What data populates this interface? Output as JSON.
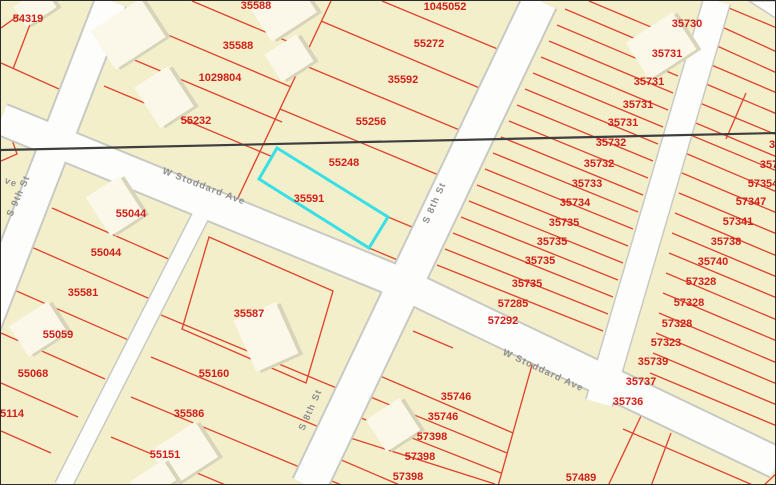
{
  "colors": {
    "parcel_fill": "#f3efcb",
    "parcel_line": "#e0452f",
    "parcel_label": "#d01f18",
    "street_fill": "#fdfdfb",
    "street_casing": "#c9c9c3",
    "street_label": "#8f8f8f",
    "building_fill": "#fbf8e9",
    "building_shadow": "#d8d4ba",
    "highlight": "#38dfe6",
    "boundary": "#3e3e3e",
    "border": "#2b2b2b"
  },
  "streets": {
    "names": [
      "S 9th St",
      "W Stoddard Ave",
      "S 8th St"
    ],
    "fragment": "ve"
  },
  "selected_parcel": {
    "label": "35591",
    "highlight_color": "#38dfe6"
  },
  "labels": {
    "nw": [
      "54319"
    ],
    "ncl": [
      "35588",
      "35588",
      "1029804",
      "55232"
    ],
    "ncr": [
      "1045052",
      "55272",
      "35592",
      "55256",
      "55248",
      "35591"
    ],
    "nem": [
      "35730",
      "35731",
      "35731",
      "35731",
      "35731",
      "35732",
      "35732",
      "35733",
      "35734",
      "35735",
      "35735",
      "35735",
      "35735",
      "57285",
      "57292"
    ],
    "nef": [
      "3",
      "357",
      "57354",
      "57347",
      "57341",
      "35738",
      "35740",
      "57328",
      "57328",
      "57328",
      "57323",
      "35739",
      "35737",
      "35736"
    ],
    "w": [
      "55044",
      "55044",
      "35581",
      "55059",
      "55068",
      "55114"
    ],
    "c": [
      "35587",
      "55160",
      "35586",
      "55151"
    ],
    "sc": [
      "35746",
      "35746",
      "57398",
      "57398",
      "57398"
    ],
    "se": [
      "57489"
    ]
  }
}
